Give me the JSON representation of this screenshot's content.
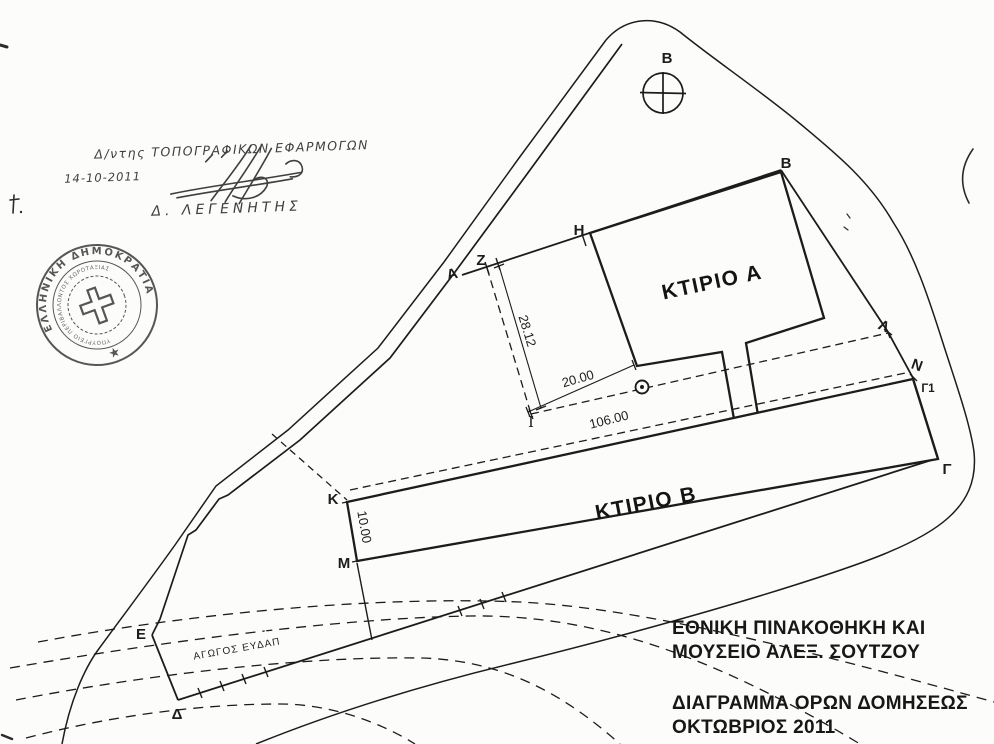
{
  "plan": {
    "north_point_label": "Β",
    "building_a_label": "ΚΤΙΡΙΟ Α",
    "building_b_label": "ΚΤΙΡΙΟ Β",
    "pipeline_label": "ΑΓΩΓΟΣ ΕΥΔΑΠ",
    "points": {
      "A": "Α",
      "Z": "Ζ",
      "H": "Η",
      "B": "Β",
      "LAMBDA": "Λ",
      "N": "Ν",
      "GAMMA1": "Γ1",
      "GAMMA": "Γ",
      "IOTA": "Ι",
      "KAPPA": "Κ",
      "MU": "Μ",
      "EPSILON": "Ε",
      "DELTA": "Δ"
    },
    "dimensions": {
      "z_to_i": "28.12",
      "i_to_corner": "20.00",
      "i_to_lambda": "106.00",
      "k_to_m": "10.00"
    }
  },
  "title_block": {
    "line1": "ΕΘΝΙΚΗ ΠΙΝΑΚΟΘΗΚΗ ΚΑΙ",
    "line2": "ΜΟΥΣΕΙΟ ΑΛΕΞ. ΣΟΥΤΖΟΥ",
    "line3": "ΔΙΑΓΡΑΜΜΑ ΟΡΩΝ ΔΟΜΗΣΕΩΣ",
    "line4": "ΟΚΤΩΒΡΙΟΣ 2011"
  },
  "handwritten_note": {
    "line1": "Δ/ντης ΤΟΠΟΓΡΑΦΙΚΩΝ ΕΦΑΡΜΟΓΩΝ",
    "date": "14-10-2011",
    "name": "Δ. ΛΕΓΕΝΗΤΗΣ"
  },
  "stamp": {
    "outer_text": "ΕΛΛΗΝΙΚΗ ΔΗΜΟΚΡΑΤΙΑ",
    "inner_text": "ΥΠΟΥΡΓΕΙΟ ΠΕΡΙΒΑΛΛΟΝΤΟΣ ΧΩΡΟΤΑΞΙΑΣ",
    "star": "★"
  },
  "colors": {
    "ink": "#1c1c1c",
    "stamp_ink": "#3a3a3a",
    "handwriting_ink": "#2b2b2b",
    "paper": "#fcfcfb"
  }
}
